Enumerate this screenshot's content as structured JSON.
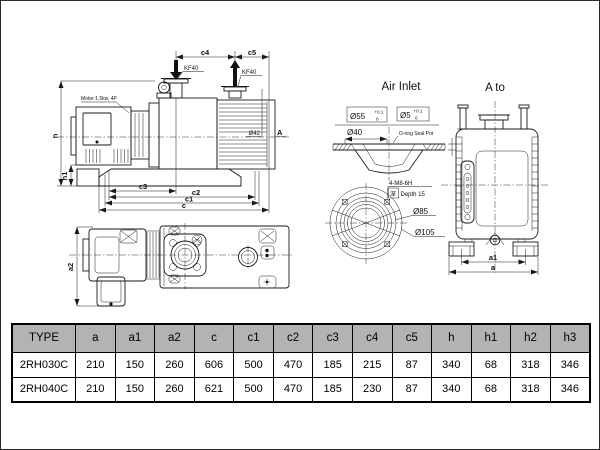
{
  "colors": {
    "line": "#1a1a1a",
    "table_header_bg": "#b3b3b3",
    "background": "#ffffff"
  },
  "side_view": {
    "motor_label": "Motor:1.5kw, 4P",
    "inlet_flange_label": "KF40",
    "exhaust_flange_label": "KF40",
    "dim_c4": "c4",
    "dim_c5": "c5",
    "dim_h": "h",
    "dim_h1": "h1",
    "dim_c3": "c3",
    "dim_c2": "c2",
    "dim_c1": "c1",
    "dim_c": "c",
    "exhaust_port_dia": "Ø42",
    "view_direction_label": "A"
  },
  "air_inlet_detail": {
    "title": "Air Inlet",
    "groove_dia": "Ø55",
    "groove_tol_upper": "+0.1",
    "groove_tol_lower": "0",
    "oring_dia": "Ø5",
    "oring_tol_upper": "+0.1",
    "oring_tol_lower": "0",
    "bore_dia": "Ø40",
    "seal_label": "O-ring Seal Pot"
  },
  "flange_detail": {
    "bolt_spec": "4-M8-6H",
    "depth_prefix": "深",
    "depth_label": "Depth 15",
    "bolt_circle_dia": "Ø85",
    "outer_dia": "Ø105"
  },
  "a_view": {
    "title": "A to",
    "dim_a1": "a1",
    "dim_a": "a"
  },
  "top_view": {
    "dim_a2": "a2"
  },
  "table": {
    "headers": [
      "TYPE",
      "a",
      "a1",
      "a2",
      "c",
      "c1",
      "c2",
      "c3",
      "c4",
      "c5",
      "h",
      "h1",
      "h2",
      "h3"
    ],
    "rows": [
      [
        "2RH030C",
        "210",
        "150",
        "260",
        "606",
        "500",
        "470",
        "185",
        "215",
        "87",
        "340",
        "68",
        "318",
        "346"
      ],
      [
        "2RH040C",
        "210",
        "150",
        "260",
        "621",
        "500",
        "470",
        "185",
        "230",
        "87",
        "340",
        "68",
        "318",
        "346"
      ]
    ]
  }
}
